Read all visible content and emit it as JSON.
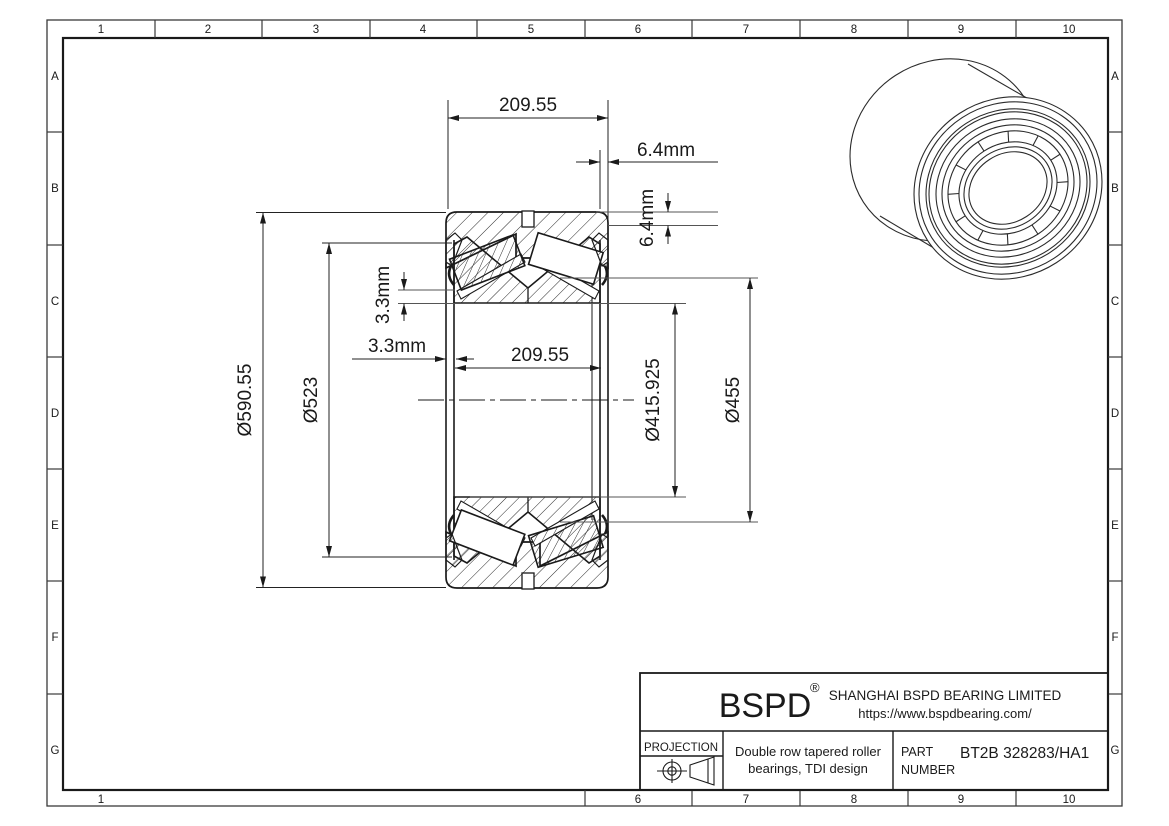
{
  "frame": {
    "cols": [
      "1",
      "2",
      "3",
      "4",
      "5",
      "6",
      "7",
      "8",
      "9",
      "10"
    ],
    "rows": [
      "A",
      "B",
      "C",
      "D",
      "E",
      "F",
      "G"
    ],
    "bottom_cols": [
      "1",
      "6",
      "7",
      "8",
      "9",
      "10"
    ]
  },
  "dims": {
    "top_width": "209.55",
    "inner_width": "209.55",
    "right_offset_h": "6.4mm",
    "right_offset_v": "6.4mm",
    "left_offset_v": "3.3mm",
    "left_offset_h": "3.3mm",
    "outer_diameter": "Ø590.55",
    "flange_diameter": "Ø523",
    "bore_diameter": "Ø415.925",
    "inner_ring_diameter": "Ø455"
  },
  "title_block": {
    "logo": "BSPD",
    "registered_mark": "®",
    "company": "SHANGHAI BSPD BEARING LIMITED",
    "website": "https://www.bspdbearing.com/",
    "projection_label": "PROJECTION",
    "description_line1": "Double row tapered roller",
    "description_line2": "bearings, TDI design",
    "part_label_line1": "PART",
    "part_label_line2": "NUMBER",
    "part_number": "BT2B 328283/HA1"
  },
  "colors": {
    "line": "#1a1a1a",
    "frame": "#3a3a3a",
    "background": "#ffffff"
  }
}
